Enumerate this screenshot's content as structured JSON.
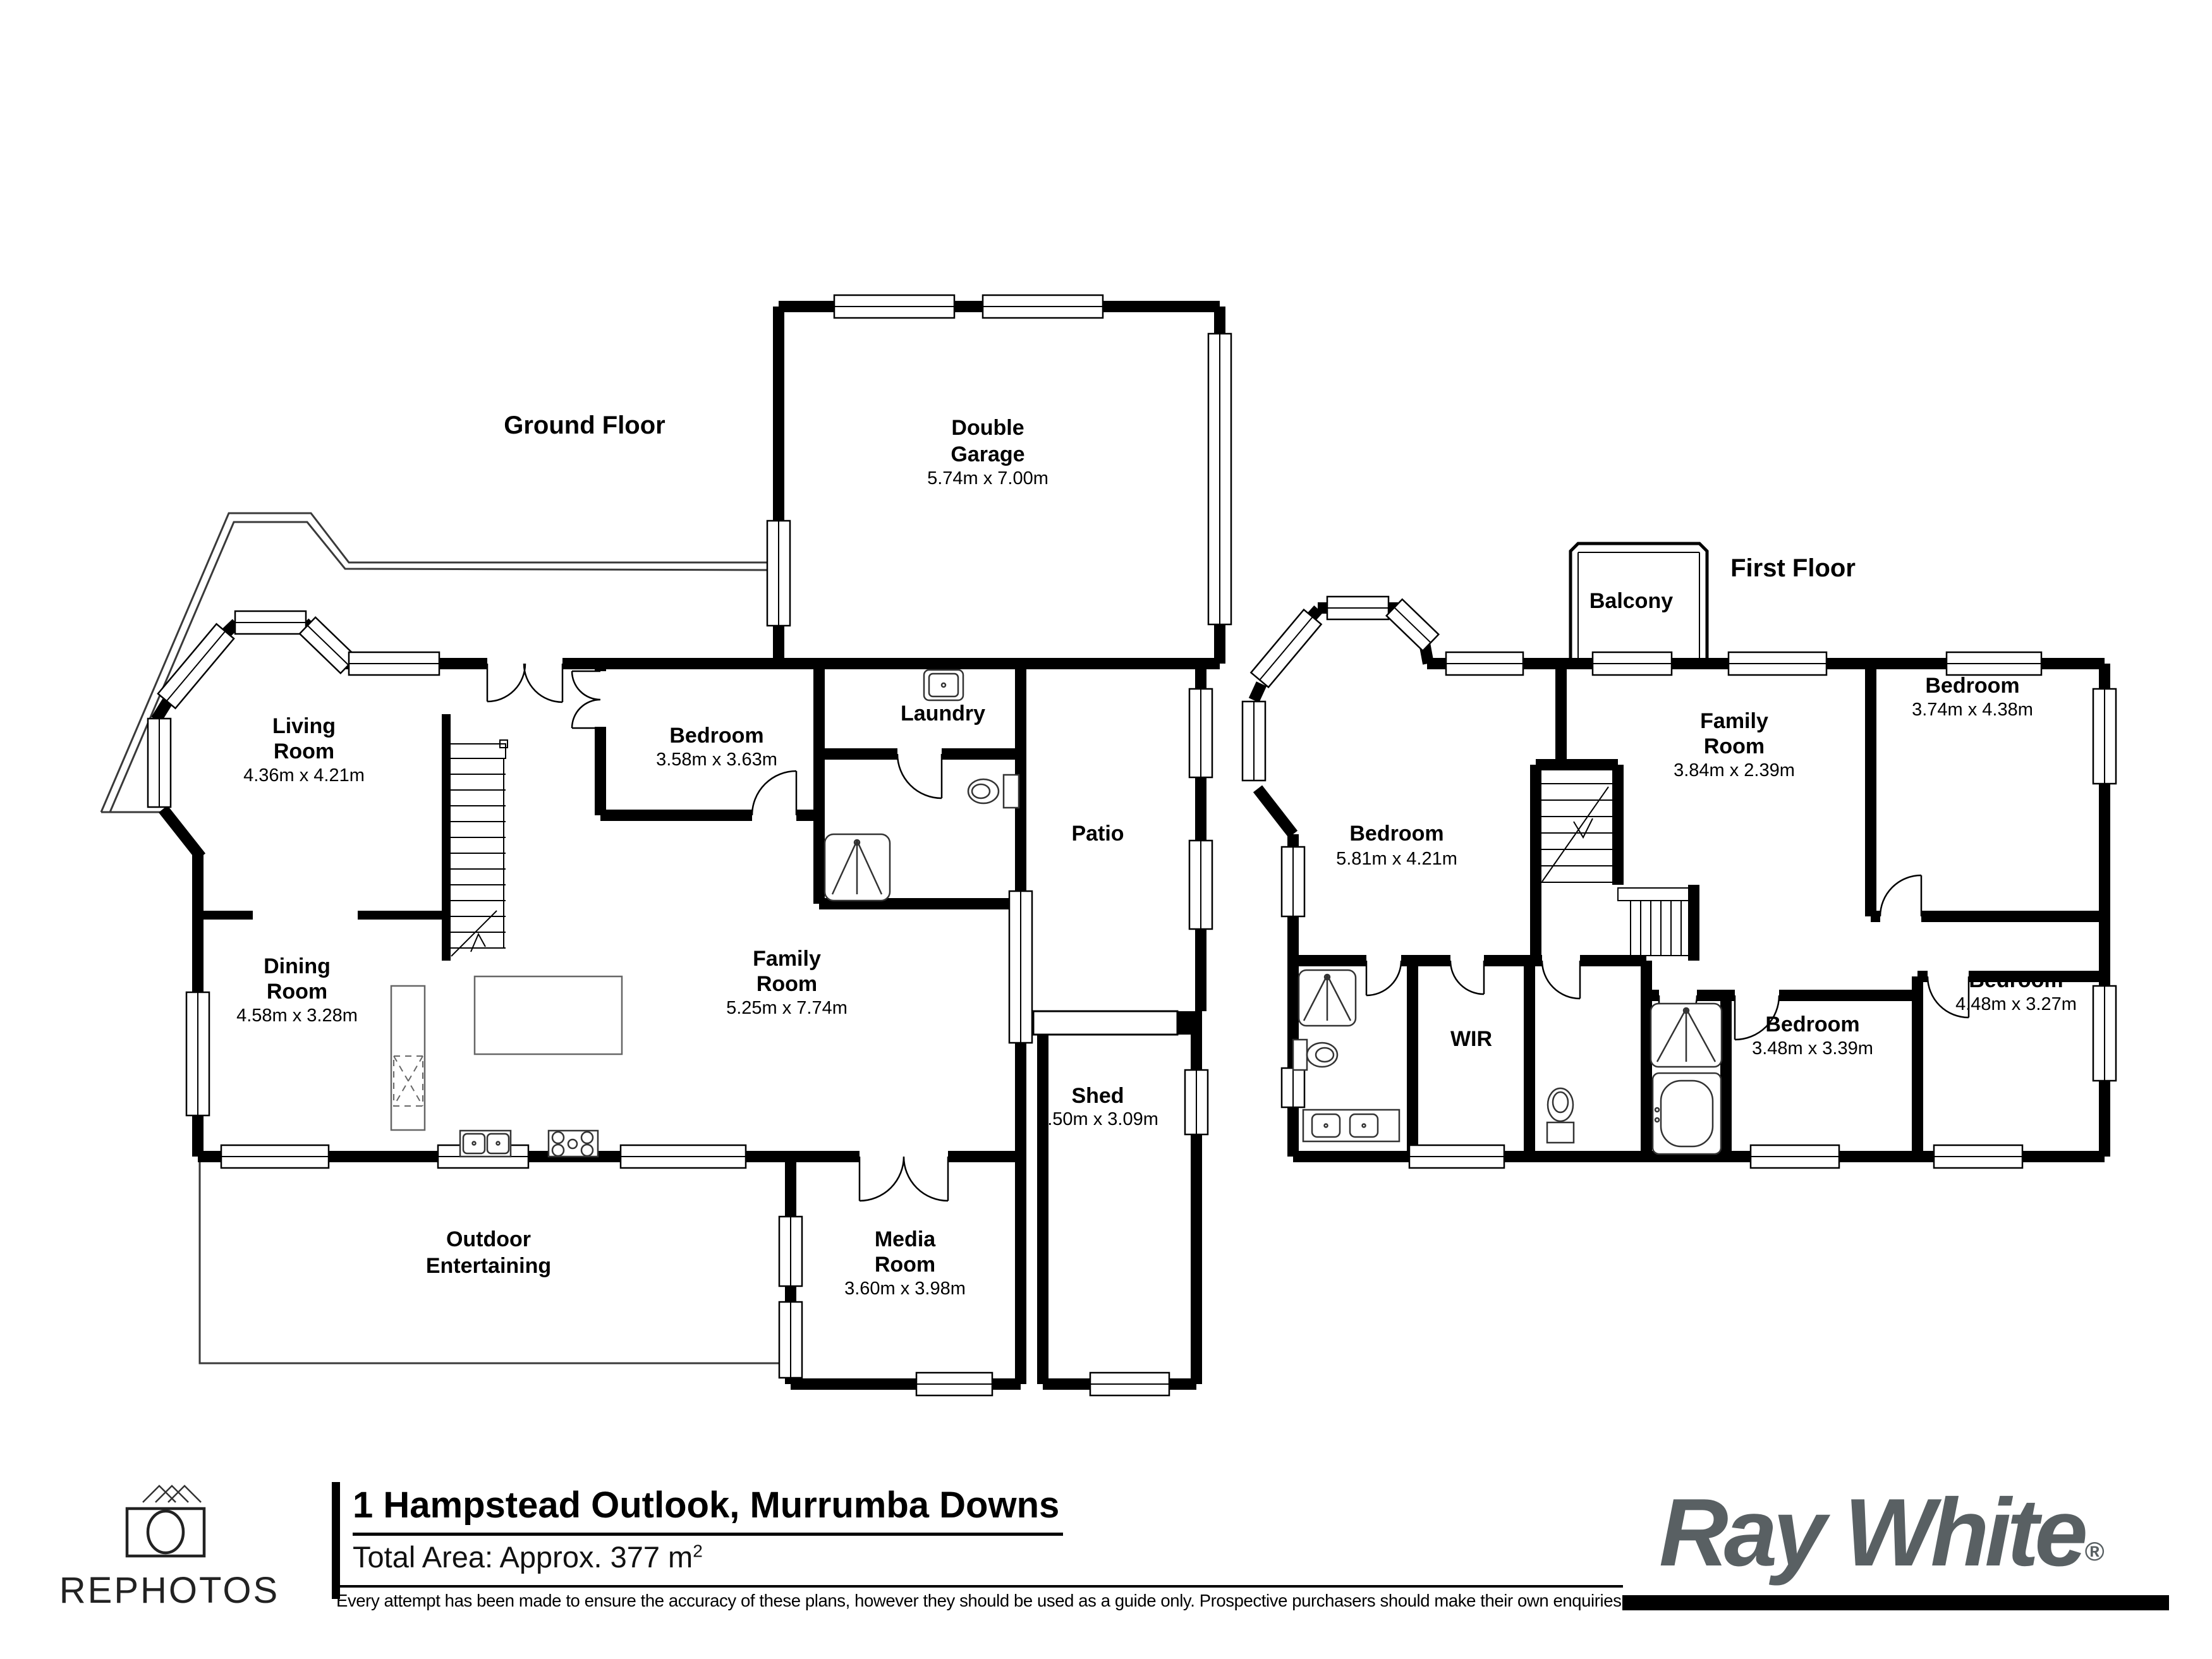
{
  "ground_floor": {
    "title": "Ground Floor",
    "rooms": {
      "double_garage": {
        "line1": "Double",
        "line2": "Garage",
        "dims": "5.74m x 7.00m"
      },
      "living": {
        "line1": "Living",
        "line2": "Room",
        "dims": "4.36m x 4.21m"
      },
      "bedroom": {
        "line1": "Bedroom",
        "dims": "3.58m x 3.63m"
      },
      "laundry": {
        "line1": "Laundry"
      },
      "dining": {
        "line1": "Dining",
        "line2": "Room",
        "dims": "4.58m x 3.28m"
      },
      "family": {
        "line1": "Family",
        "line2": "Room",
        "dims": "5.25m x 7.74m"
      },
      "patio": {
        "line1": "Patio"
      },
      "outdoor": {
        "line1": "Outdoor",
        "line2": "Entertaining"
      },
      "media": {
        "line1": "Media",
        "line2": "Room",
        "dims": "3.60m x 3.98m"
      },
      "shed": {
        "line1": "Shed",
        "dims": "4.50m x 3.09m"
      }
    }
  },
  "first_floor": {
    "title": "First Floor",
    "rooms": {
      "balcony": {
        "line1": "Balcony"
      },
      "bedroom_master": {
        "line1": "Bedroom",
        "dims": "5.81m x 4.21m"
      },
      "family": {
        "line1": "Family",
        "line2": "Room",
        "dims": "3.84m x 2.39m"
      },
      "bedroom_top_right": {
        "line1": "Bedroom",
        "dims": "3.74m x 4.38m"
      },
      "bedroom_bottom_mid": {
        "line1": "Bedroom",
        "dims": "3.48m x 3.39m"
      },
      "bedroom_bottom_right": {
        "line1": "Bedroom",
        "dims": "4.48m x 3.27m"
      },
      "wir": {
        "line1": "WIR"
      }
    }
  },
  "footer": {
    "brand": "REPHOTOS",
    "address": "1 Hampstead Outlook, Murrumba Downs",
    "total_area_label": "Total Area: Approx. 377 m",
    "total_area_sup": "2",
    "disclaimer": "Every attempt has been made to ensure the accuracy of these plans, however they should be used as a guide only.  Prospective purchasers should make their own enquiries",
    "agency": "Ray White",
    "registered_mark": "®"
  },
  "colors": {
    "wall": "#000000",
    "fixture": "#333333",
    "agency_gray": "#596063"
  }
}
